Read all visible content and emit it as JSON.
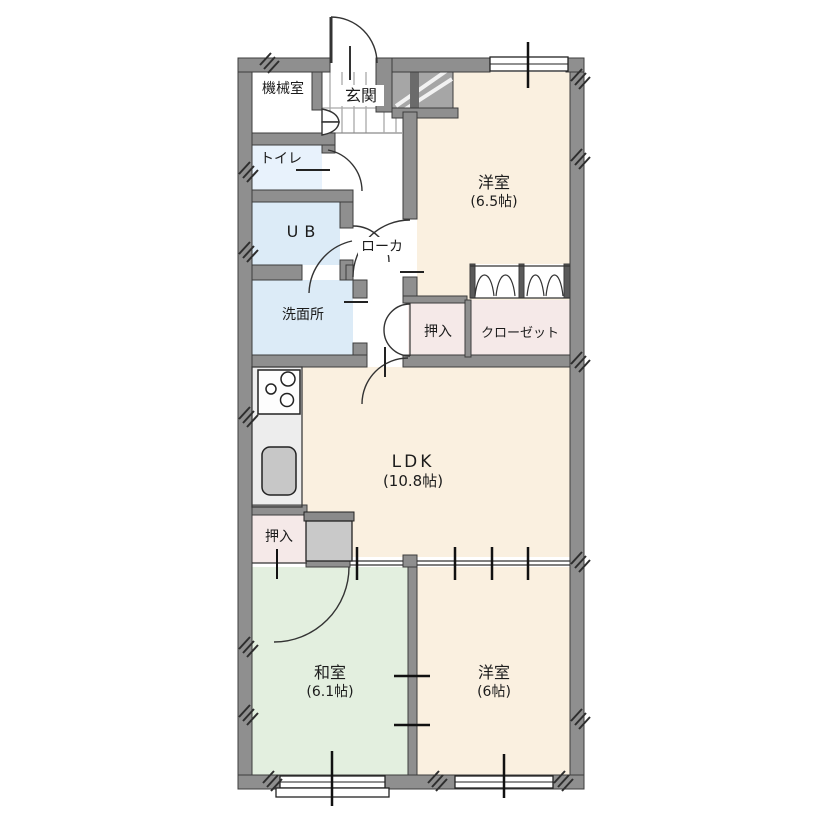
{
  "plan_title": "apartment-floor-plan",
  "rooms": {
    "machine_room": {
      "label": "機械室"
    },
    "entrance": {
      "label": "玄関"
    },
    "toilet": {
      "label": "トイレ"
    },
    "unit_bath": {
      "label": "UB"
    },
    "corridor": {
      "label": "ローカ"
    },
    "washroom": {
      "label": "洗面所"
    },
    "western1": {
      "label": "洋室",
      "size": "(6.5帖)"
    },
    "oshiire_upper": {
      "label": "押入"
    },
    "closet": {
      "label": "クローゼット"
    },
    "ldk": {
      "label": "LDK",
      "size": "(10.8帖)"
    },
    "oshiire_lower": {
      "label": "押入"
    },
    "japanese_room": {
      "label": "和室",
      "size": "(6.1帖)"
    },
    "western2": {
      "label": "洋室",
      "size": "(6帖)"
    }
  },
  "colors": {
    "wall": "#8f8f8f",
    "wall_outline": "#3c3c3c",
    "western_room_floor": "#faf0e0",
    "japanese_room_floor": "#e3efdf",
    "wet_area_floor": "#dcebf7",
    "toilet_floor": "#e8f2fc",
    "closet_floor": "#f5e9e8",
    "kitchen_floor": "#ededed",
    "stair_block": "#a6a6a6",
    "sink": "#c7c7c7",
    "appliance": "#c9c9c9"
  }
}
